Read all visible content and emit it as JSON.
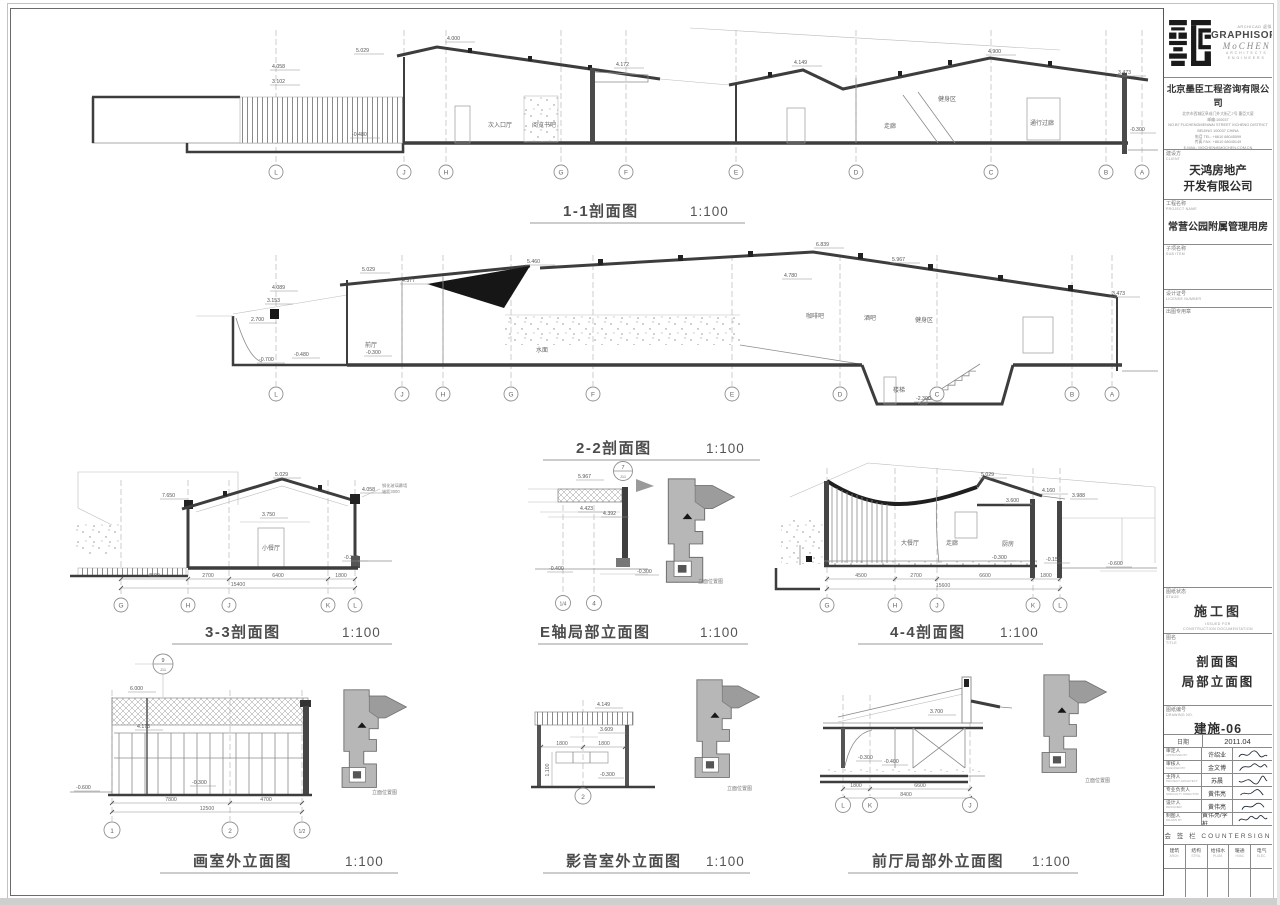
{
  "colors": {
    "paper": "#ffffff",
    "line": "#3d3d3d",
    "grey_fill": "#b7b7b7",
    "black_fill": "#161616"
  },
  "titles": [
    {
      "label": "1-1剖面图",
      "scale": "1:100"
    },
    {
      "label": "2-2剖面图",
      "scale": "1:100"
    },
    {
      "label": "3-3剖面图",
      "scale": "1:100"
    },
    {
      "label": "E轴局部立面图",
      "scale": "1:100"
    },
    {
      "label": "4-4剖面图",
      "scale": "1:100"
    },
    {
      "label": "画室外立面图",
      "scale": "1:100"
    },
    {
      "label": "影音室外立面图",
      "scale": "1:100"
    },
    {
      "label": "前厅局部外立面图",
      "scale": "1:100"
    }
  ],
  "dw": {
    "s11": {
      "grids": [
        "L",
        "J",
        "H",
        "G",
        "F",
        "E",
        "D",
        "C",
        "B",
        "A"
      ],
      "levels": [
        "5.029",
        "4.058",
        "3.102",
        "4.000",
        "4.172",
        "4.149",
        "4.900",
        "3.473",
        "-0.480",
        "-0.300"
      ],
      "rooms": [
        "次入口厅",
        "阅览书吧",
        "走廊",
        "健身区",
        "通行过廊"
      ]
    },
    "s22": {
      "grids": [
        "L",
        "J",
        "H",
        "G",
        "F",
        "E",
        "D",
        "C",
        "B",
        "A"
      ],
      "levels": [
        "5.029",
        "4.577",
        "5.460",
        "4.089",
        "3.153",
        "2.700",
        "6.839",
        "5.967",
        "4.780",
        "3.473",
        "-0.700",
        "-0.480",
        "-0.300",
        "-2.300"
      ],
      "rooms": [
        "前厅",
        "水面",
        "咖啡吧",
        "酒吧",
        "健身区",
        "楼梯"
      ]
    },
    "s33": {
      "grids": [
        "G",
        "H",
        "J",
        "K",
        "L"
      ],
      "levels": [
        "7.650",
        "5.029",
        "4.058",
        "3.750",
        "-0.300"
      ],
      "dims": [
        "4500",
        "2700",
        "6400",
        "1800"
      ],
      "total": "15400",
      "rooms": [
        "小餐厅"
      ],
      "notes": [
        "钢化玻璃幕墙",
        "轴距3000"
      ]
    },
    "eaxis": {
      "grids": [
        "1/4",
        "4"
      ],
      "levels": [
        "5.967",
        "4.423",
        "4.392",
        "-0.400",
        "-0.300"
      ],
      "detail_num": "7",
      "detail_sheet": "J11",
      "keymap": "立面位置图"
    },
    "s44": {
      "grids": [
        "G",
        "H",
        "J",
        "K",
        "L"
      ],
      "levels": [
        "5.029",
        "3.600",
        "4.160",
        "3.988",
        "-0.300",
        "-0.150",
        "-0.600"
      ],
      "dims": [
        "4500",
        "2700",
        "6600",
        "1800"
      ],
      "total": "15600",
      "rooms": [
        "大餐厅",
        "走廊",
        "厨房"
      ]
    },
    "studio": {
      "grids": [
        "1",
        "2",
        "1/2"
      ],
      "levels": [
        "6.000",
        "4.173",
        "-0.300",
        "-0.600"
      ],
      "dims": [
        "7800",
        "4700"
      ],
      "total": "12500",
      "detail_num": "9",
      "detail_sheet": "J11",
      "keymap": "立面位置图"
    },
    "av": {
      "grids": [
        "2"
      ],
      "levels": [
        "4.149",
        "3.609",
        "-0.300"
      ],
      "dims": [
        "1800",
        "1800"
      ],
      "vdim": "1.100",
      "keymap": "立面位置图"
    },
    "foyer": {
      "grids": [
        "L",
        "K",
        "J"
      ],
      "levels": [
        "3.700",
        "-0.300",
        "-0.400"
      ],
      "dims": [
        "1800",
        "6600"
      ],
      "total": "8400",
      "keymap": "立面位置图"
    }
  },
  "titleblock": {
    "archicad": "ARCHICAD 虚拟建筑",
    "brand": "GRAPHISOFT",
    "firm": "MoCHEN",
    "firm_sub1": "ARCHITECTS",
    "firm_sub2": "ENGINEERS",
    "company": "北京墨臣工程咨询有限公司",
    "addr1": "北京市西城区阜成门外大街乙7号 墨臣大厦",
    "addr2": "邮编:100037",
    "addr3": "NO.B7 FUCHENGMENWAI STREET XICHENG DISTRICT",
    "addr4": "BEIJING 100037 CHINA",
    "addr5": "电话 TEL: +8610 68045599",
    "addr6": "传真 FAX: +8610 68045149",
    "addr7": "E-MAIL: MOCHEN@MOCHEN.COM.CN",
    "addr8": "HTTP://WWW.MOCHEN.COM.CN",
    "client_label": "建设方",
    "client_label_en": "CLIENT",
    "client_line1": "天鸿房地产",
    "client_line2": "开发有限公司",
    "project_label": "工程名称",
    "project_label_en": "PROJECT NAME",
    "project": "常营公园附属管理用房",
    "subitem_label": "子项名称",
    "subitem_label_en": "SUB ITEM",
    "license_label": "设计证号",
    "license_label_en": "LICENSE NUMBER",
    "seal_label": "出图专用章",
    "stage_label": "图纸状态",
    "stage_label_en": "STAGE",
    "stage": "施工图",
    "stage_en1": "ISSUED FOR",
    "stage_en2": "CONSTRUCTION DOCUMENTATION",
    "sheet_title_label": "图名",
    "sheet_title_label_en": "TITLE",
    "sheet_title1": "剖面图",
    "sheet_title2": "局部立面图",
    "number_label": "图纸编号",
    "number_label_en": "DRAWING NO.",
    "number": "建施-06",
    "date_label": "日期",
    "date": "2011.04",
    "people": [
      {
        "role": "审定人",
        "role_en": "APPROVED BY",
        "name": "许绍业"
      },
      {
        "role": "审核人",
        "role_en": "CHECKED BY",
        "name": "金文博"
      },
      {
        "role": "主持人",
        "role_en": "PROJECT ARCHITECT",
        "name": "苏晨"
      },
      {
        "role": "专业负责人",
        "role_en": "SPECIALTY DIRECTOR",
        "name": "黄伟亮"
      },
      {
        "role": "设计人",
        "role_en": "DESIGNER",
        "name": "黄伟亮"
      },
      {
        "role": "制图人",
        "role_en": "DRAWN BY",
        "name": "黄伟亮/李桩"
      }
    ],
    "countersign": "会 签 栏  COUNTERSIGN",
    "cols": [
      {
        "cn": "建筑",
        "en": "ARCH."
      },
      {
        "cn": "结构",
        "en": "STRU."
      },
      {
        "cn": "给排水",
        "en": "PLUM."
      },
      {
        "cn": "暖通",
        "en": "HVAC"
      },
      {
        "cn": "电气",
        "en": "ELEC."
      }
    ]
  }
}
